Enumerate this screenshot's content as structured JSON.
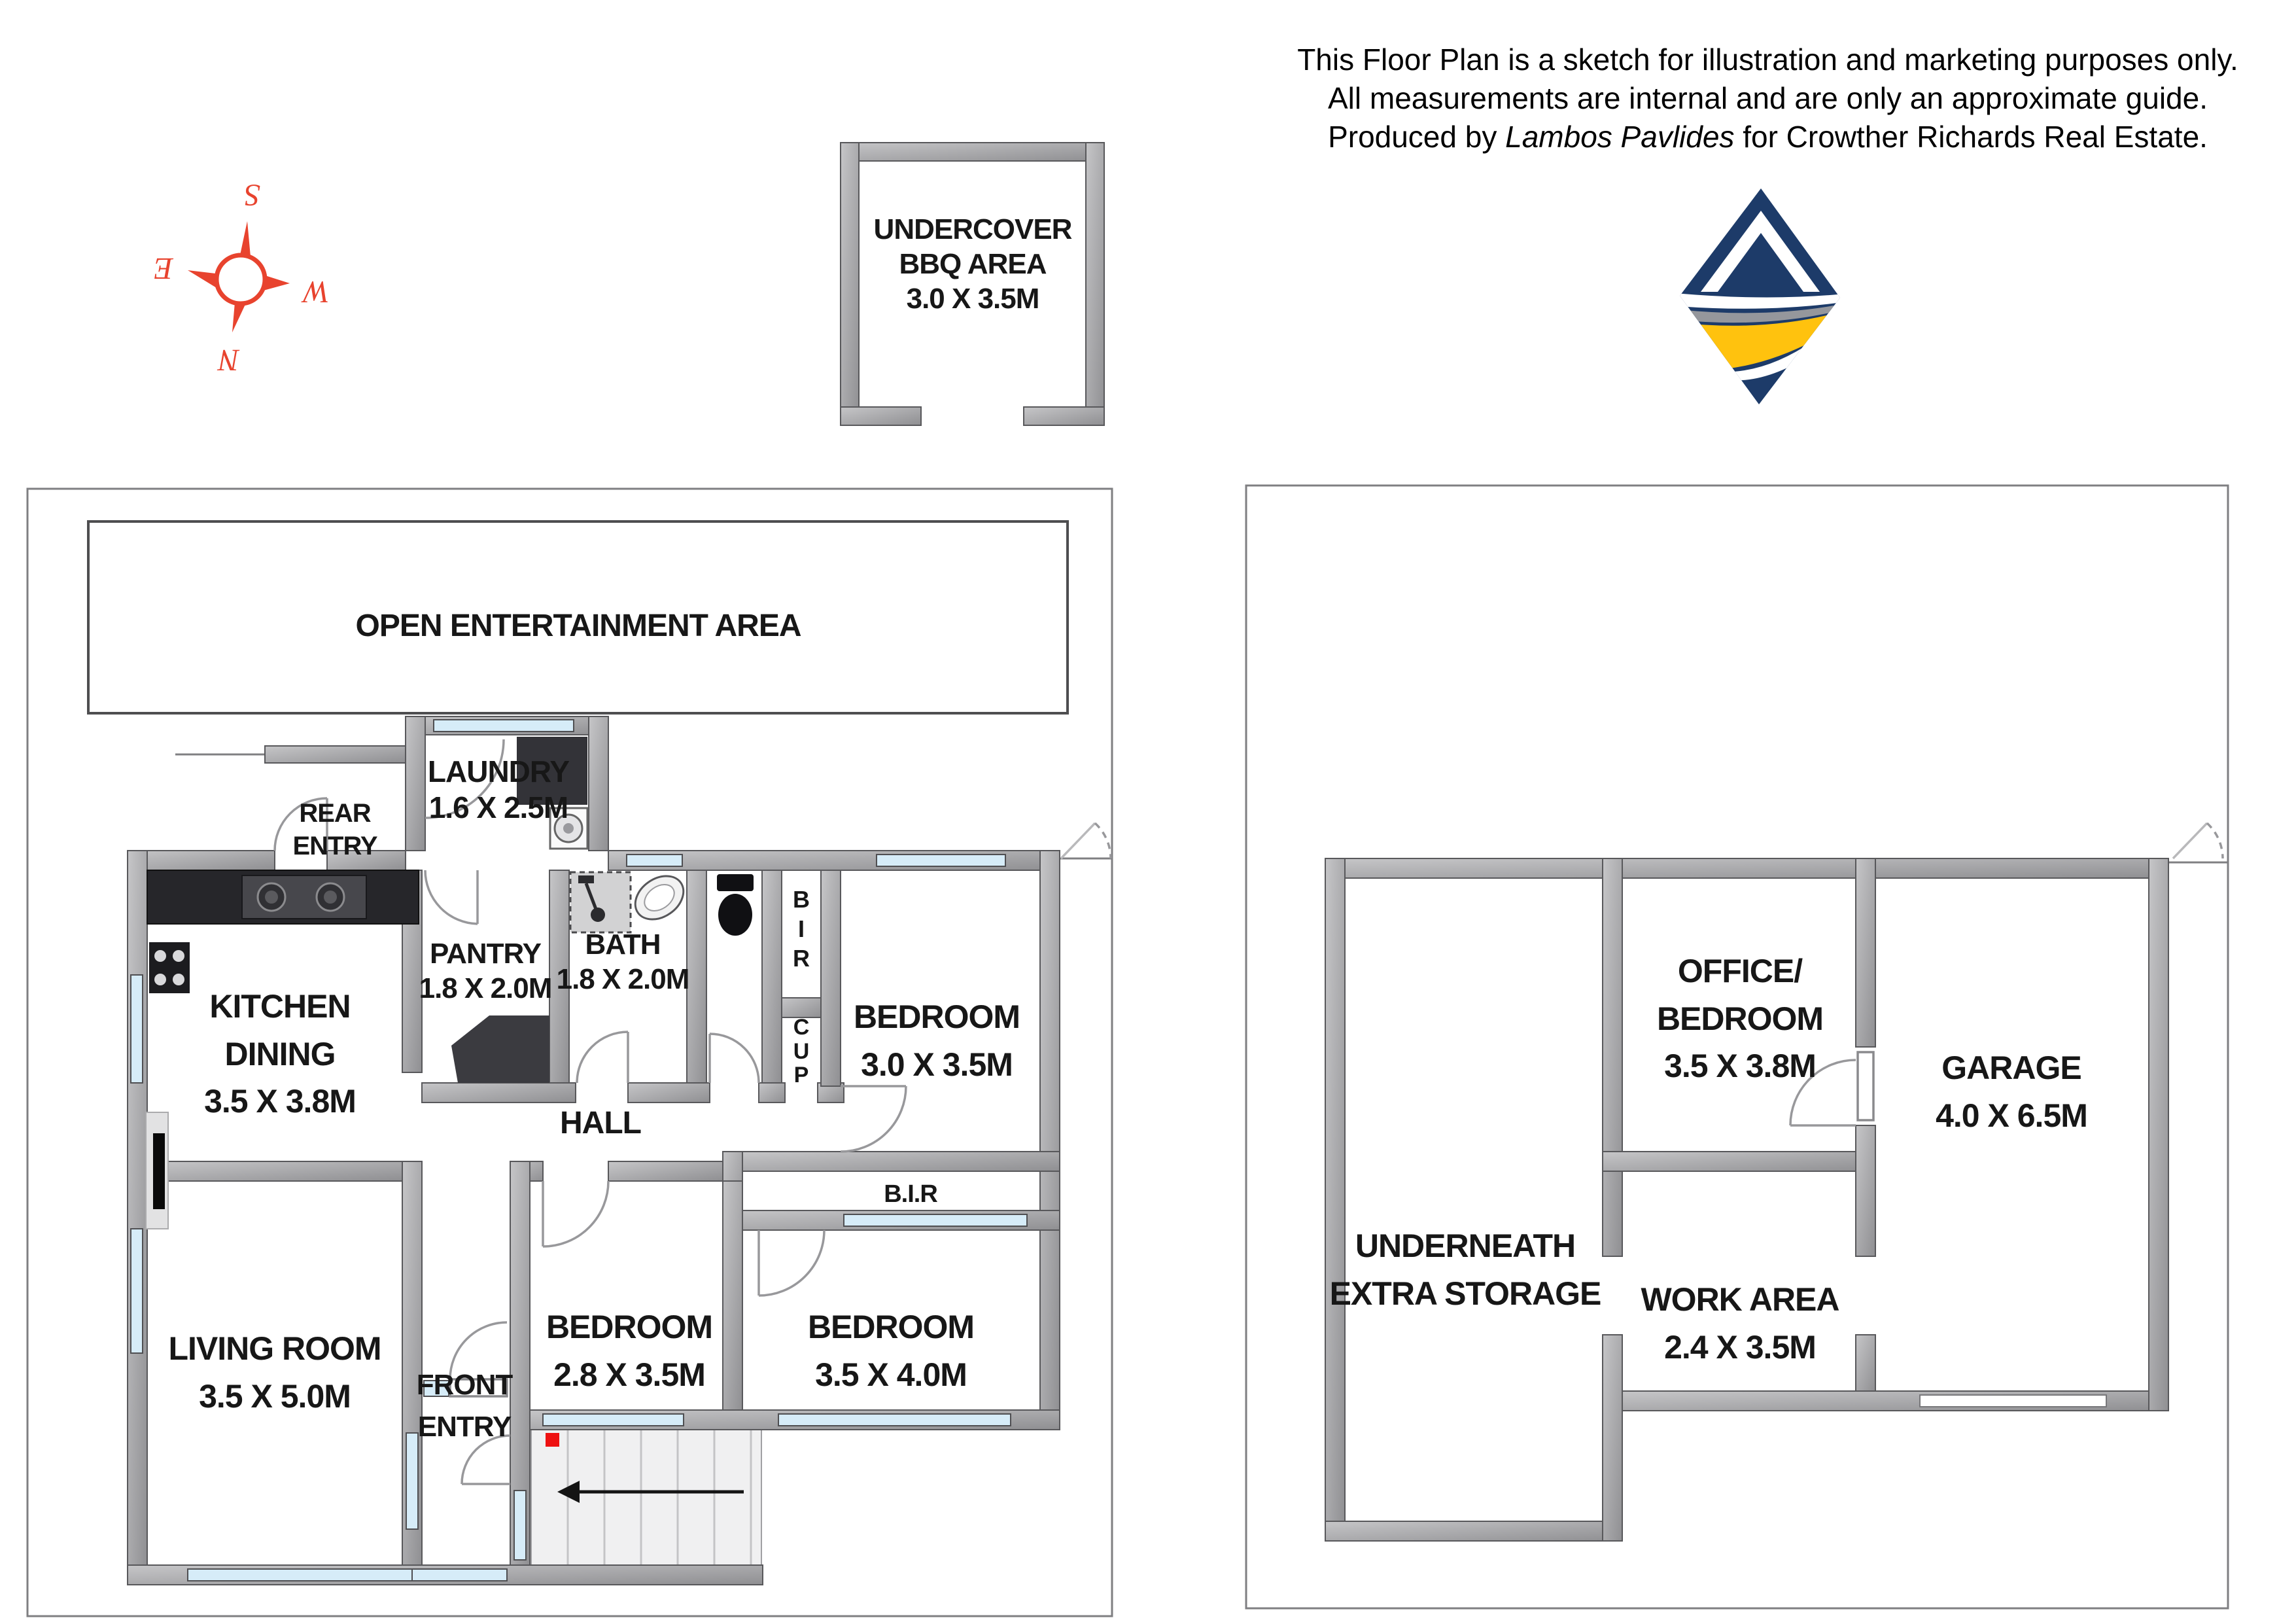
{
  "disclaimer": {
    "line1": "This Floor Plan is a sketch for illustration and marketing purposes only.",
    "line2": "All measurements are internal  and are only an approximate guide.",
    "line3_prefix": "Produced by ",
    "line3_italic": "Lambos Pavlides",
    "line3_suffix": " for Crowther Richards Real Estate."
  },
  "compass": {
    "top": "S",
    "right": "W",
    "bottom": "N",
    "left": "E"
  },
  "bbq": {
    "label": "UNDERCOVER\nBBQ AREA\n3.0 X 3.5M"
  },
  "ground_floor": {
    "open_entertainment": "OPEN ENTERTAINMENT AREA",
    "rear_entry": "REAR\nENTRY",
    "laundry": "LAUNDRY\n1.6 X 2.5M",
    "kitchen_dining": "KITCHEN\nDINING\n3.5 X 3.8M",
    "pantry": "PANTRY\n1.8 X 2.0M",
    "bath": "BATH\n1.8 X 2.0M",
    "bir_closet": "B\nI\nR",
    "cup_closet": "C\nU\nP",
    "bedroom1": "BEDROOM\n3.0 X 3.5M",
    "hall": "HALL",
    "bir_strip": "B.I.R",
    "bedroom2": "BEDROOM\n2.8 X 3.5M",
    "bedroom3": "BEDROOM\n3.5 X 4.0M",
    "living_room": "LIVING ROOM\n3.5 X 5.0M",
    "front_entry": "FRONT\nENTRY"
  },
  "lower_floor": {
    "storage": "UNDERNEATH\nEXTRA STORAGE",
    "office": "OFFICE/\nBEDROOM\n3.5 X 3.8M",
    "garage": "GARAGE\n4.0 X 6.5M",
    "work_area": "WORK AREA\n2.4 X 3.5M"
  },
  "colors": {
    "wall_light": "#c6c6c8",
    "wall_dark": "#8f8f92",
    "window_blue": "#d6ecf8",
    "compass_red": "#e8432e",
    "marker_red": "#ee1111",
    "logo_navy": "#1d3b69",
    "logo_gold": "#ffc20e"
  }
}
